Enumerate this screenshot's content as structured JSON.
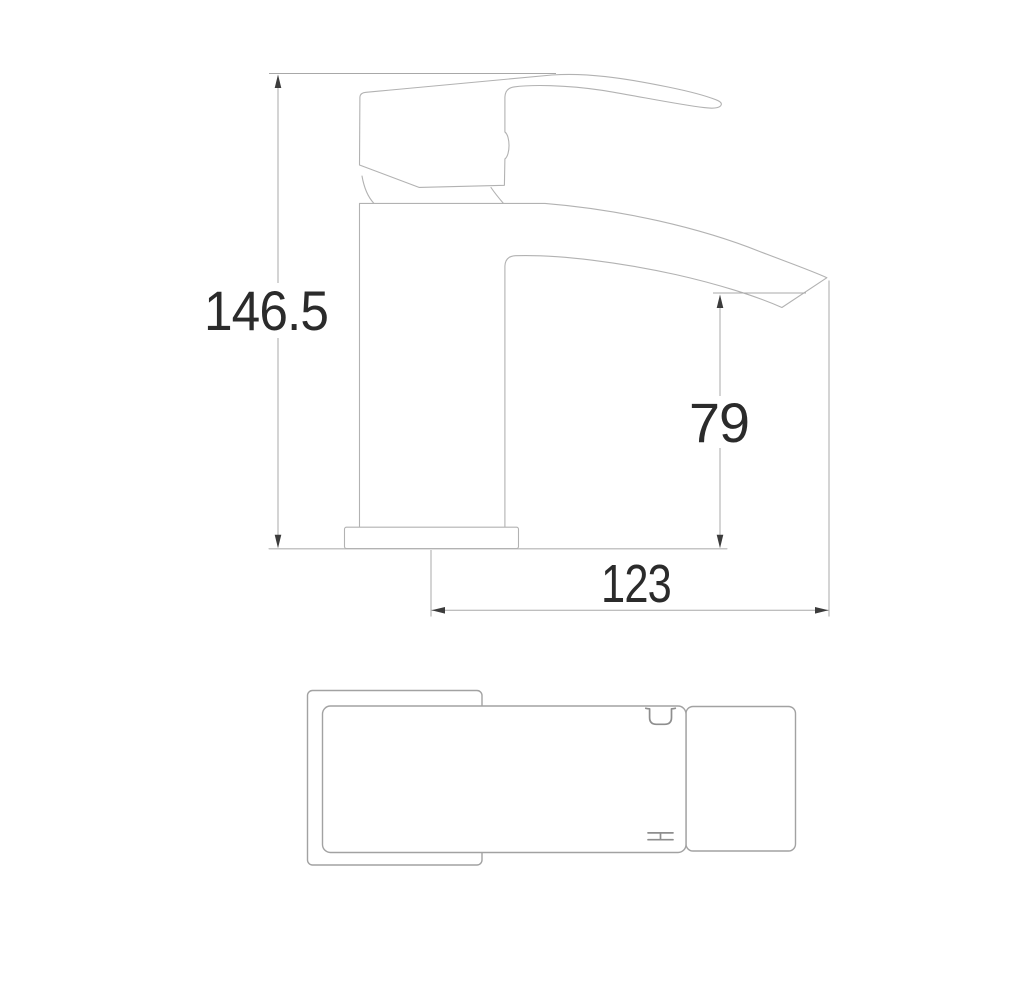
{
  "page": {
    "background": "#ffffff"
  },
  "drawing": {
    "type": "technical-dimension-drawing",
    "subject": "mono basin mixer tap - side elevation and plan view",
    "colors": {
      "outline_line": "#b2b2b2",
      "plan_line": "#a2a2a2",
      "dimension_line": "#a8a8a8",
      "arrow": "#3c3c3c",
      "text": "#2b2b2b"
    },
    "dimensions": [
      {
        "id": "overall_height",
        "value": "146.5",
        "orientation": "vertical"
      },
      {
        "id": "spout_height",
        "value": "79",
        "orientation": "vertical"
      },
      {
        "id": "spout_projection",
        "value": "123",
        "orientation": "horizontal"
      }
    ]
  }
}
